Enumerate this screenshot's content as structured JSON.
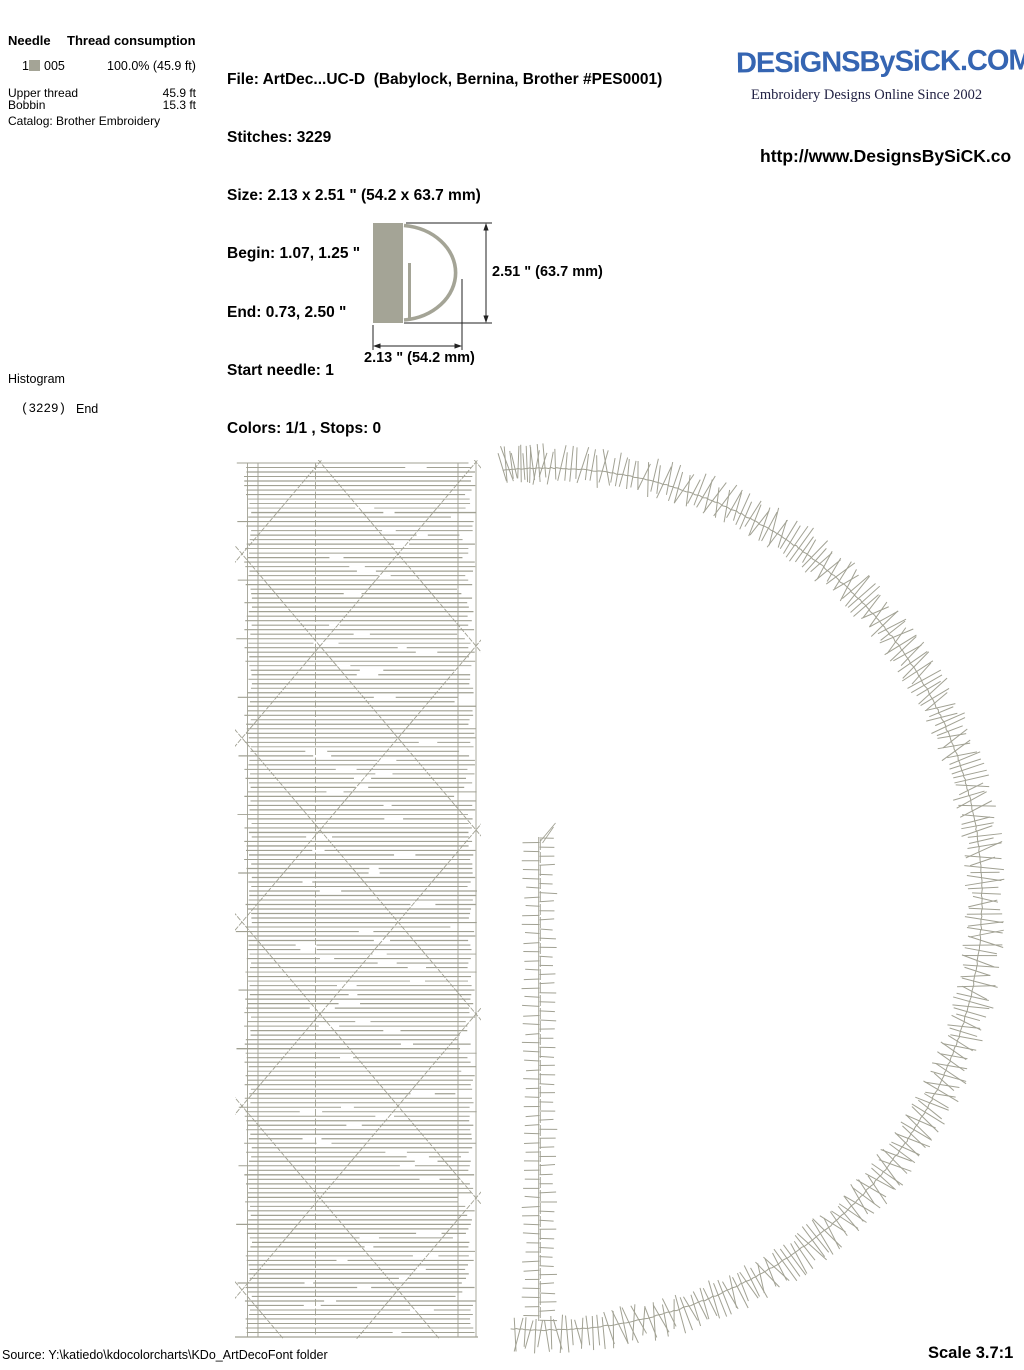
{
  "page": {
    "bg": "#ffffff",
    "stitch_color": "#a1a193",
    "fill_color": "#a4a496"
  },
  "needle_table": {
    "col1_header": "Needle",
    "col2_header": "Thread consumption",
    "row": {
      "needle": "1",
      "swatch_color": "#a4a496",
      "color_code": "005",
      "consumption": "100.0% (45.9 ft)"
    },
    "upper_thread_label": "Upper thread",
    "upper_thread_value": "45.9 ft",
    "bobbin_label": "Bobbin",
    "bobbin_value": "15.3 ft",
    "catalog": "Catalog: Brother Embroidery"
  },
  "file_info": {
    "lines": [
      "File: ArtDec...UC-D  (Babylock, Bernina, Brother #PES0001)",
      "Stitches: 3229",
      "Size: 2.13 x 2.51 \" (54.2 x 63.7 mm)",
      "Begin: 1.07, 1.25 \"",
      "End: 0.73, 2.50 \"",
      "Start needle: 1",
      "Colors: 1/1 , Stops: 0"
    ]
  },
  "brand": {
    "logo_text": "DESiGNSBySiCK.COM",
    "logo_color": "#3565b2",
    "tagline": "Embroidery Designs Online Since 2002",
    "url_visible": "http://www.DesignsBySiCK.co"
  },
  "thumbnail": {
    "height_label": "2.51 \" (63.7 mm)",
    "width_label": "2.13 \" (54.2 mm)"
  },
  "histogram": {
    "title": "Histogram",
    "count": "(3229)",
    "end_label": "End"
  },
  "footer": {
    "source": "Source: Y:\\katiedo\\kdocolorcharts\\KDo_ArtDecoFont folder",
    "scale": "Scale 3.7:1"
  },
  "design": {
    "letter": "D",
    "bar": {
      "x1": 244,
      "x2": 477,
      "y1": 463,
      "y2": 1337
    },
    "bowl": {
      "cx": 545,
      "cy": 899,
      "rx": 437,
      "ry": 431
    },
    "column": {
      "x": 539.5,
      "y1": 823,
      "y2": 1321
    }
  }
}
